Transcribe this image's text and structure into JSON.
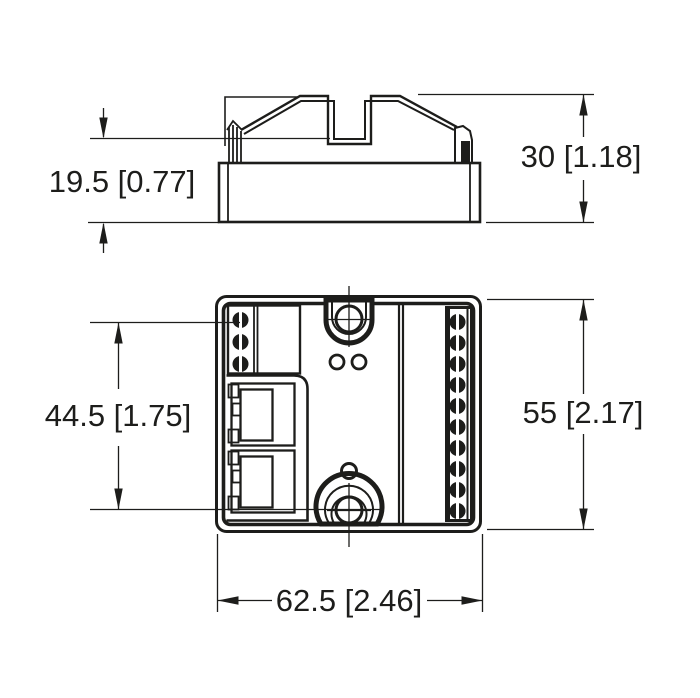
{
  "drawing": {
    "kind": "technical dimension drawing",
    "background_color": "#ffffff",
    "line_color": "#1d1d1b",
    "views": {
      "side_view": "device side profile with DIN housing, top notch and latch tabs",
      "front_view": "device front face with terminals, RJ45 ports and mounting holes"
    },
    "features": {
      "left_terminal_count": 3,
      "right_terminal_count": 10,
      "rj45_port_count": 2,
      "led_count": 2,
      "mounting_hole_count": 2
    }
  },
  "dimensions": [
    {
      "id": "upper-section-height",
      "label": "19.5 [0.77]",
      "mm": 19.5,
      "inch": 0.77
    },
    {
      "id": "total-height-side",
      "label": "30 [1.18]",
      "mm": 30,
      "inch": 1.18
    },
    {
      "id": "connector-span",
      "label": "44.5 [1.75]",
      "mm": 44.5,
      "inch": 1.75
    },
    {
      "id": "body-height",
      "label": "55 [2.17]",
      "mm": 55,
      "inch": 2.17
    },
    {
      "id": "body-width",
      "label": "62.5 [2.46]",
      "mm": 62.5,
      "inch": 2.46
    }
  ]
}
